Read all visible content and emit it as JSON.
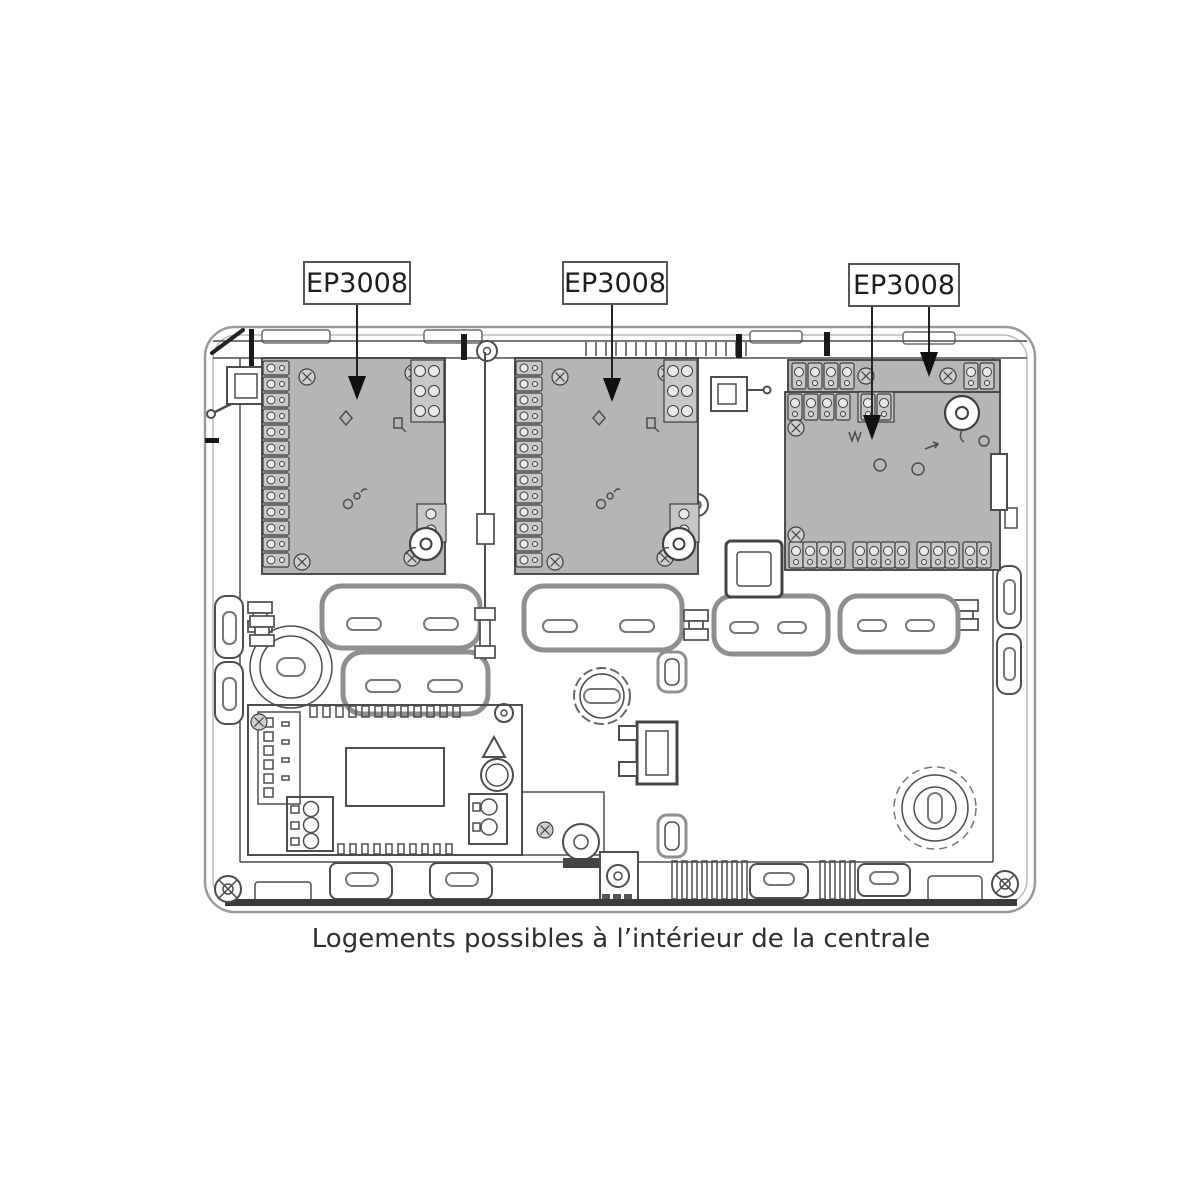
{
  "diagram": {
    "caption": "Logements possibles à l’intérieur de la centrale",
    "module_labels": {
      "label1": "EP3008",
      "label2": "EP3008",
      "label3": "EP3008"
    }
  },
  "colors": {
    "board_fill": "#b5b5b5",
    "component_fill": "#c7c7c7",
    "outline": "#4d4d4d",
    "case_outline": "#9a9a9a",
    "knockout_outline": "#8f8f8f",
    "arrow": "#111111",
    "label_text": "#1d1d1d",
    "caption_text": "#2f2f2f"
  }
}
